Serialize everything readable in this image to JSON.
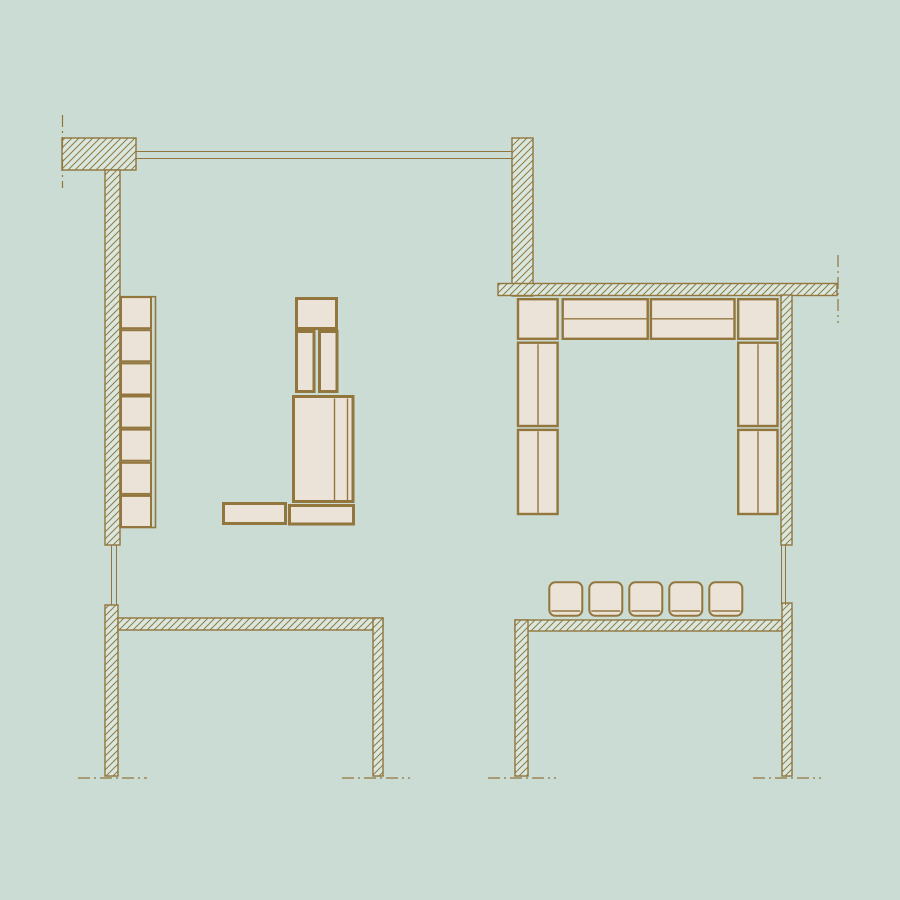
{
  "title": "furniture-floor-plan-drawing",
  "colors": {
    "background": "#cadcd3",
    "wall_fill": "#d8e8e0",
    "line": "#92763e",
    "hatch_line": "#96793f",
    "furniture_fill": "#ece3d8"
  },
  "canvas": {
    "width": 900,
    "height": 900
  },
  "walls": [
    {
      "name": "wall-block-top-left",
      "x": 62,
      "y": 138,
      "w": 74,
      "h": 32
    },
    {
      "name": "wall-left-upper",
      "x": 105,
      "y": 170,
      "w": 15,
      "h": 375
    },
    {
      "name": "wall-top-center",
      "x": 512,
      "y": 138,
      "w": 21,
      "h": 158
    },
    {
      "name": "wall-right-horizontal",
      "x": 498,
      "y": 283.5,
      "w": 339,
      "h": 12
    },
    {
      "name": "wall-right-upper",
      "x": 781,
      "y": 295,
      "w": 11,
      "h": 250
    },
    {
      "name": "wall-room-a-left",
      "x": 105,
      "y": 605,
      "w": 13,
      "h": 171
    },
    {
      "name": "wall-room-a-top",
      "x": 118,
      "y": 618,
      "w": 265,
      "h": 12
    },
    {
      "name": "wall-room-a-right",
      "x": 373,
      "y": 618,
      "w": 10,
      "h": 158
    },
    {
      "name": "wall-room-b-top",
      "x": 515,
      "y": 620,
      "w": 277,
      "h": 11
    },
    {
      "name": "wall-room-b-left",
      "x": 515,
      "y": 620,
      "w": 13,
      "h": 156
    },
    {
      "name": "wall-room-b-right",
      "x": 782,
      "y": 603,
      "w": 10,
      "h": 173
    }
  ],
  "window_lines": [
    {
      "name": "window-top-line-outer",
      "x1": 136,
      "y1": 151.5,
      "x2": 512,
      "y2": 151.5
    },
    {
      "name": "window-top-line-inner",
      "x1": 136,
      "y1": 158.5,
      "x2": 512,
      "y2": 158.5
    },
    {
      "name": "window-left-line-outer",
      "x1": 111.5,
      "y1": 545,
      "x2": 111.5,
      "y2": 605
    },
    {
      "name": "window-left-line-inner",
      "x1": 116.5,
      "y1": 545,
      "x2": 116.5,
      "y2": 605
    },
    {
      "name": "window-right-line-outer",
      "x1": 781.5,
      "y1": 545,
      "x2": 781.5,
      "y2": 605
    },
    {
      "name": "window-right-line-inner",
      "x1": 785.5,
      "y1": 545,
      "x2": 785.5,
      "y2": 605
    }
  ],
  "centerlines": [
    {
      "name": "centerline-top-left",
      "x1": 62.5,
      "y1": 115,
      "x2": 62.5,
      "y2": 188
    },
    {
      "name": "centerline-top-right",
      "x1": 838,
      "y1": 255,
      "x2": 838,
      "y2": 323
    },
    {
      "name": "section-line-bottom-1",
      "x1": 78,
      "y1": 778,
      "x2": 147,
      "y2": 778
    },
    {
      "name": "section-line-bottom-2",
      "x1": 342,
      "y1": 778,
      "x2": 410,
      "y2": 778
    },
    {
      "name": "section-line-bottom-3",
      "x1": 488,
      "y1": 778,
      "x2": 556,
      "y2": 778
    },
    {
      "name": "section-line-bottom-4",
      "x1": 753,
      "y1": 778,
      "x2": 821,
      "y2": 778
    }
  ],
  "shelf_column": {
    "frame": {
      "name": "shelf-outer-frame",
      "x": 120,
      "y": 296.7,
      "w": 35.5,
      "h": 230.8,
      "sw": 1.6
    },
    "cells": [
      {
        "name": "shelf-cell-1",
        "x": 121,
        "y": 297.1,
        "w": 30,
        "h": 31.1,
        "sw": 2
      },
      {
        "name": "shelf-cell-2",
        "x": 121,
        "y": 330.2,
        "w": 30,
        "h": 31.1,
        "sw": 2
      },
      {
        "name": "shelf-cell-3",
        "x": 121,
        "y": 363.4,
        "w": 30,
        "h": 31.1,
        "sw": 2
      },
      {
        "name": "shelf-cell-4",
        "x": 121,
        "y": 396.5,
        "w": 30,
        "h": 31.1,
        "sw": 2
      },
      {
        "name": "shelf-cell-5",
        "x": 121,
        "y": 429.6,
        "w": 30,
        "h": 31.1,
        "sw": 2
      },
      {
        "name": "shelf-cell-6",
        "x": 121,
        "y": 462.8,
        "w": 30,
        "h": 31.1,
        "sw": 2
      },
      {
        "name": "shelf-cell-7",
        "x": 121,
        "y": 495.9,
        "w": 30,
        "h": 31.1,
        "sw": 2
      }
    ]
  },
  "furniture": [
    {
      "name": "cabinet-top-box",
      "x": 296.5,
      "y": 298.5,
      "w": 40,
      "h": 30,
      "sw": 3
    },
    {
      "name": "cabinet-tall-left",
      "x": 296.5,
      "y": 331.5,
      "w": 17.5,
      "h": 60,
      "sw": 3
    },
    {
      "name": "cabinet-tall-right",
      "x": 319.5,
      "y": 331.5,
      "w": 17.5,
      "h": 60,
      "sw": 3
    },
    {
      "name": "cabinet-big-box",
      "x": 293.5,
      "y": 396.5,
      "w": 59.5,
      "h": 105,
      "sw": 3,
      "dividers": [
        [
          334.5,
          398.5,
          334.5,
          500
        ],
        [
          347.5,
          398.5,
          347.5,
          500
        ]
      ]
    },
    {
      "name": "bench-left",
      "x": 223.5,
      "y": 503.5,
      "w": 62,
      "h": 20,
      "sw": 3
    },
    {
      "name": "bench-right",
      "x": 289.5,
      "y": 505.5,
      "w": 64,
      "h": 18.5,
      "sw": 3
    },
    {
      "name": "sofa-corner-left",
      "x": 518,
      "y": 299.2,
      "w": 39.6,
      "h": 39.6,
      "sw": 2.4
    },
    {
      "name": "sofa-top-1",
      "x": 562.7,
      "y": 299.2,
      "w": 85,
      "h": 39.6,
      "sw": 2.4,
      "dividers": [
        [
          563.9,
          318.8,
          646.5,
          318.8
        ]
      ]
    },
    {
      "name": "sofa-top-2",
      "x": 650.9,
      "y": 299.2,
      "w": 83.6,
      "h": 39.6,
      "sw": 2.4,
      "dividers": [
        [
          652.1,
          318.8,
          733.3,
          318.8
        ]
      ]
    },
    {
      "name": "sofa-corner-right",
      "x": 738.2,
      "y": 299.2,
      "w": 39.3,
      "h": 39.6,
      "sw": 2.4
    },
    {
      "name": "sofa-left-upper",
      "x": 518,
      "y": 342.7,
      "w": 39.6,
      "h": 83.3,
      "sw": 2.4,
      "dividers": [
        [
          538,
          344.2,
          538,
          424.8
        ]
      ]
    },
    {
      "name": "sofa-left-lower",
      "x": 518,
      "y": 429.9,
      "w": 39.6,
      "h": 84.1,
      "sw": 2.4,
      "dividers": [
        [
          538,
          431.4,
          538,
          512.8
        ]
      ]
    },
    {
      "name": "sofa-right-upper",
      "x": 738.2,
      "y": 342.7,
      "w": 39.3,
      "h": 83.3,
      "sw": 2.4,
      "dividers": [
        [
          758,
          344.2,
          758,
          424.8
        ]
      ]
    },
    {
      "name": "sofa-right-lower",
      "x": 738.2,
      "y": 429.9,
      "w": 39.3,
      "h": 84.1,
      "sw": 2.4,
      "dividers": [
        [
          758,
          431.4,
          758,
          512.8
        ]
      ]
    }
  ],
  "stools": [
    {
      "name": "stool-1",
      "x": 549.3,
      "y": 582.3,
      "w": 33,
      "h": 33.5,
      "r": 6,
      "seat_line_y": 611,
      "sw": 2
    },
    {
      "name": "stool-2",
      "x": 589.3,
      "y": 582.3,
      "w": 33,
      "h": 33.5,
      "r": 6,
      "seat_line_y": 611,
      "sw": 2
    },
    {
      "name": "stool-3",
      "x": 629.3,
      "y": 582.3,
      "w": 33,
      "h": 33.5,
      "r": 6,
      "seat_line_y": 611,
      "sw": 2
    },
    {
      "name": "stool-4",
      "x": 669.3,
      "y": 582.3,
      "w": 33,
      "h": 33.5,
      "r": 6,
      "seat_line_y": 611,
      "sw": 2
    },
    {
      "name": "stool-5",
      "x": 709.3,
      "y": 582.3,
      "w": 33,
      "h": 33.5,
      "r": 6,
      "seat_line_y": 611,
      "sw": 2
    }
  ]
}
